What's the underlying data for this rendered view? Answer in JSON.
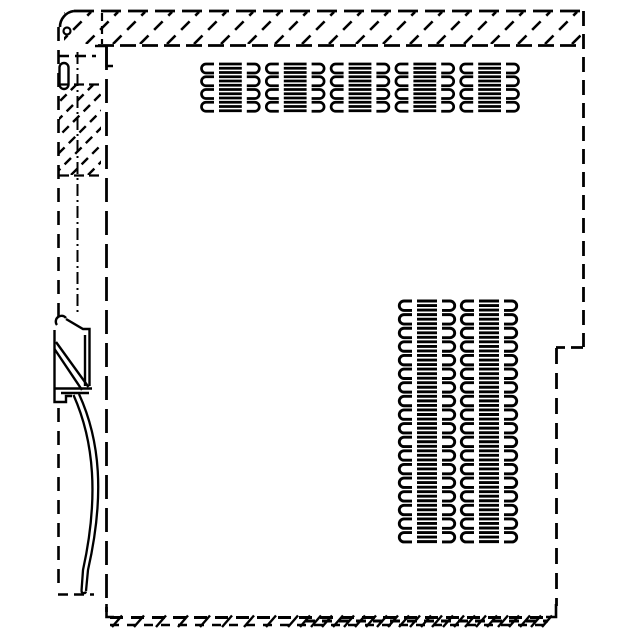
{
  "meta": {
    "description": "Monochrome CAD-style technical line drawing: side view of a DIN-rail mounted electronic module housing with hatched mounting flange, ventilation slot grids, DIN-rail latch clip and release strap",
    "canvas": {
      "width": 640,
      "height": 640
    }
  },
  "colors": {
    "ink": "#000000",
    "paper": "#ffffff"
  },
  "drawing": {
    "lines": [
      {
        "n": "flange-top-edge",
        "g": "outline",
        "x1": 74,
        "y1": 11,
        "x2": 585,
        "y2": 11,
        "dash": "20 7",
        "w": 2.8
      },
      {
        "n": "flange-bottom-edge",
        "g": "outline",
        "x1": 98,
        "y1": 45.5,
        "x2": 578,
        "y2": 45.5,
        "dash": "16 6",
        "w": 2.8
      },
      {
        "n": "flange-hidden-strip-edge",
        "g": "outline",
        "x1": 102,
        "y1": 13,
        "x2": 102,
        "y2": 44,
        "dash": "8 5",
        "w": 2.2
      },
      {
        "n": "right-edge-upper",
        "g": "outline",
        "x1": 583.5,
        "y1": 11,
        "x2": 583.5,
        "y2": 347,
        "dash": "15 8",
        "w": 2.8
      },
      {
        "n": "right-step-edge",
        "g": "outline",
        "x1": 583,
        "y1": 347.5,
        "x2": 556,
        "y2": 347.5,
        "dash": "12 6",
        "w": 2.8
      },
      {
        "n": "right-edge-lower",
        "g": "outline",
        "x1": 556.5,
        "y1": 348,
        "x2": 556.5,
        "y2": 606,
        "dash": "16 9",
        "w": 2.8
      },
      {
        "n": "bottom-edge-line-upper",
        "g": "outline",
        "x1": 110,
        "y1": 617.5,
        "x2": 548,
        "y2": 617.5,
        "dash": "13 8",
        "w": 3
      },
      {
        "n": "bottom-edge-line-lower",
        "g": "outline",
        "x1": 110,
        "y1": 625,
        "x2": 548,
        "y2": 625,
        "dash": "9 8",
        "w": 2.6
      },
      {
        "n": "bottom-edge-line-dense",
        "g": "outline",
        "x1": 305,
        "y1": 621,
        "x2": 548,
        "y2": 621,
        "dash": "10 7",
        "w": 3
      },
      {
        "n": "body-left-edge",
        "g": "outline",
        "x1": 106.5,
        "y1": 46,
        "x2": 106.5,
        "y2": 612,
        "dash": "24 9",
        "w": 2.8
      },
      {
        "n": "strip-left-edge-upper",
        "g": "outline",
        "x1": 58.5,
        "y1": 27,
        "x2": 58.5,
        "y2": 318,
        "dash": "14 9",
        "w": 2.6
      },
      {
        "n": "strip-left-edge-lower",
        "g": "outline",
        "x1": 58.5,
        "y1": 408,
        "x2": 58.5,
        "y2": 592,
        "dash": "14 9",
        "w": 2.6
      },
      {
        "n": "strip-top-edge",
        "g": "outline",
        "x1": 58,
        "y1": 56,
        "x2": 96,
        "y2": 56,
        "dash": "11 6",
        "w": 2.4
      },
      {
        "n": "strip-bottom-edge",
        "g": "outline",
        "x1": 58,
        "y1": 594.5,
        "x2": 94,
        "y2": 594.5,
        "dash": "10 6",
        "w": 2.4
      },
      {
        "n": "strip-center-axis",
        "g": "outline",
        "x1": 77.5,
        "y1": 52,
        "x2": 77.5,
        "y2": 316,
        "dash": "12 4 2 4",
        "w": 2
      },
      {
        "n": "strip-hatch-top-border",
        "g": "hatch",
        "x1": 59,
        "y1": 84.5,
        "x2": 101,
        "y2": 84.5,
        "dash": "10 5",
        "w": 2.2
      },
      {
        "n": "strip-hatch-bottom-border",
        "g": "hatch",
        "x1": 59,
        "y1": 175.5,
        "x2": 101,
        "y2": 175.5,
        "dash": "10 5",
        "w": 2.2
      }
    ],
    "paths": [
      {
        "n": "flange-corner-arc",
        "g": "outline",
        "d": "M74,11 A16,16 0 0 0 60,27",
        "w": 2.6
      },
      {
        "n": "body-top-junction",
        "g": "outline",
        "d": "M95,46 H106.5 V66 H113",
        "w": 2.6
      },
      {
        "n": "body-bottom-corner",
        "g": "outline",
        "d": "M106.5,604 V617 H114",
        "w": 2.6
      },
      {
        "n": "right-bottom-corner",
        "g": "outline",
        "d": "M556,604 V617 H546",
        "w": 2.6
      },
      {
        "n": "strip-slot",
        "g": "outline",
        "d": "M59.5,67.5 a4.5,4.5 0 0 1 9,0 V84.5 a4.5,4.5 0 0 1 -9,0 Z",
        "w": 2.4
      },
      {
        "n": "clip-hook-loop",
        "g": "clip",
        "d": "M66,318 a5.5,5.5 0 1 0 -9,7",
        "w": 2.4
      },
      {
        "n": "clip-left-edge",
        "g": "clip",
        "d": "M54.5,330 V391",
        "w": 2.4
      },
      {
        "n": "clip-foot",
        "g": "clip",
        "d": "M54.5,391 V402 H66 V396 H72",
        "w": 2.4
      },
      {
        "n": "clip-top-right-edge",
        "g": "clip",
        "d": "M66,319 L83,329 H89.5 V386",
        "w": 2.4
      },
      {
        "n": "clip-inner-right-edge",
        "g": "clip",
        "d": "M85,335 V386",
        "w": 2.4
      },
      {
        "n": "clip-spring-diagonal-1",
        "g": "clip",
        "d": "M56,342 L88.5,387",
        "w": 2.4
      },
      {
        "n": "clip-spring-diagonal-2",
        "g": "clip",
        "d": "M54.5,349 L82,390",
        "w": 2.4
      },
      {
        "n": "clip-bottom-edge-1",
        "g": "clip",
        "d": "M54,388.5 H92",
        "w": 2.4
      },
      {
        "n": "clip-bottom-edge-2",
        "g": "clip",
        "d": "M61,393 H89",
        "w": 2.4
      },
      {
        "n": "strap-outer-curve",
        "g": "strap",
        "d": "M79,394 C100,440 105,495 88,570 L86,591",
        "w": 2.3
      },
      {
        "n": "strap-inner-curve",
        "g": "strap",
        "d": "M73.5,395 C94,441 99,497 83,570 L81.5,591",
        "w": 2.3
      },
      {
        "n": "strap-tip",
        "g": "strap",
        "d": "M81.5,591 a2.3,2.3 0 0 0 4.5,0.5",
        "w": 2.3
      }
    ],
    "circles": [
      {
        "n": "flange-corner-hole",
        "g": "outline",
        "cx": 67,
        "cy": 31,
        "r": 3.5,
        "w": 2.2
      }
    ],
    "hatches": [
      {
        "n": "flange-hatch",
        "g": "hatch",
        "clip": [
          64,
          12,
          517,
          32
        ],
        "pitch": 27,
        "dash": "12 8",
        "w": 2.6
      },
      {
        "n": "strip-hatch",
        "g": "hatch",
        "clip": [
          59,
          85,
          42,
          90
        ],
        "pitch": 17,
        "dash": "9 6",
        "w": 2.4
      }
    ],
    "ticks": [
      {
        "n": "bottom-band-ticks-sparse",
        "g": "hatch",
        "x1": 112,
        "x2": 300,
        "pitch": 22,
        "yTop": 615.5,
        "yBot": 627,
        "dx": 10,
        "w": 2.4
      },
      {
        "n": "bottom-band-ticks-dense",
        "g": "hatch",
        "x1": 300,
        "x2": 545,
        "pitch": 11,
        "yTop": 615.5,
        "yBot": 627,
        "dx": 10,
        "w": 2.4
      }
    ],
    "vents": [
      {
        "n": "vent-grid-top",
        "g": "vent",
        "x": 198,
        "y": 64,
        "cols": 5,
        "rows": 4,
        "cellW": 64.8,
        "rowPitch": 12.75,
        "slotH": 9,
        "barPitch": 4.25,
        "barCount": 12,
        "barIn": 21,
        "armIn": 16,
        "capR": 4.5,
        "w": 2.7
      },
      {
        "n": "vent-grid-bottom",
        "g": "vent",
        "x": 396,
        "y": 301,
        "cols": 2,
        "rows": 18,
        "cellW": 62,
        "rowPitch": 13.62,
        "slotH": 9.4,
        "barPitch": 4.54,
        "barCount": 54,
        "barIn": 21,
        "armIn": 16,
        "capR": 4.7,
        "w": 2.9
      }
    ]
  }
}
